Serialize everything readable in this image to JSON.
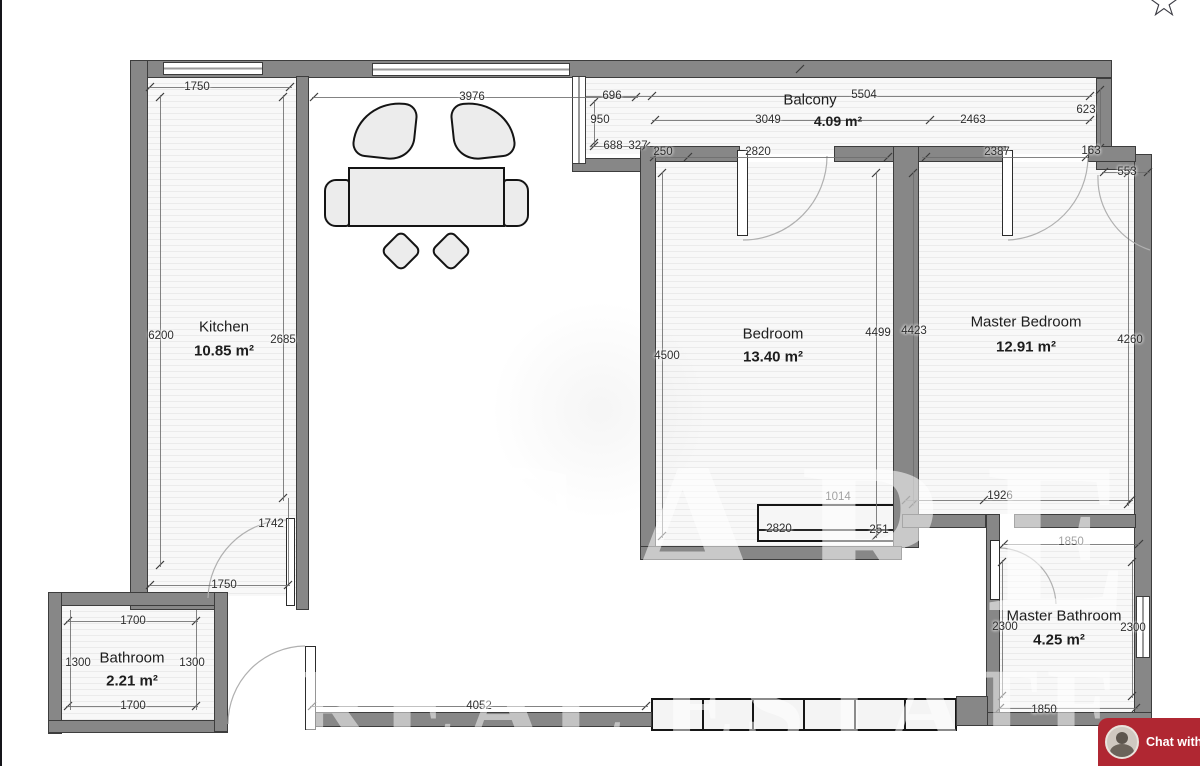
{
  "colors": {
    "wall": "#878787",
    "chat_red": "#b02732",
    "dim_text": "#2e2e2e"
  },
  "star_icon": "☆",
  "chat": {
    "label": "Chat with"
  },
  "watermark": {
    "line1": "CARE",
    "line2": "REAL ESTATE"
  },
  "rooms": {
    "kitchen": {
      "name": "Kitchen",
      "area": "10.85 m²"
    },
    "balcony": {
      "name": "Balcony",
      "area": "4.09 m²"
    },
    "bedroom": {
      "name": "Bedroom",
      "area": "13.40 m²"
    },
    "master_bedroom": {
      "name": "Master Bedroom",
      "area": "12.91 m²"
    },
    "bathroom": {
      "name": "Bathroom",
      "area": "2.21 m²"
    },
    "master_bathroom": {
      "name": "Master Bathroom",
      "area": "4.25 m²"
    }
  },
  "dims": {
    "kitchen_top": "1750",
    "living_top": "3976",
    "balcony_696": "696",
    "balcony_total": "5504",
    "balcony_950": "950",
    "balcony_3049": "3049",
    "balcony_2463": "2463",
    "balcony_623": "623",
    "balcony_688": "688",
    "balcony_327": "327",
    "bedroom_250": "250",
    "bedroom_top": "2820",
    "master_top": "2387",
    "master_163": "163",
    "master_553": "553",
    "kitchen_left": "6200",
    "kitchen_right": "2685",
    "kitchen_1742": "1742",
    "kitchen_bottom": "1750",
    "bedroom_left": "4500",
    "bedroom_right": "4499",
    "master_left": "4423",
    "master_right": "4260",
    "hall_1014": "1014",
    "hall_1926": "1926",
    "radiator_2820": "2820",
    "radiator_251": "251",
    "mbath_top": "1850",
    "mbath_left": "2300",
    "mbath_right": "2300",
    "mbath_bottom": "1850",
    "bath_top": "1700",
    "bath_left": "1300",
    "bath_right": "1300",
    "bath_bottom": "1700",
    "hall_4052": "4052"
  }
}
